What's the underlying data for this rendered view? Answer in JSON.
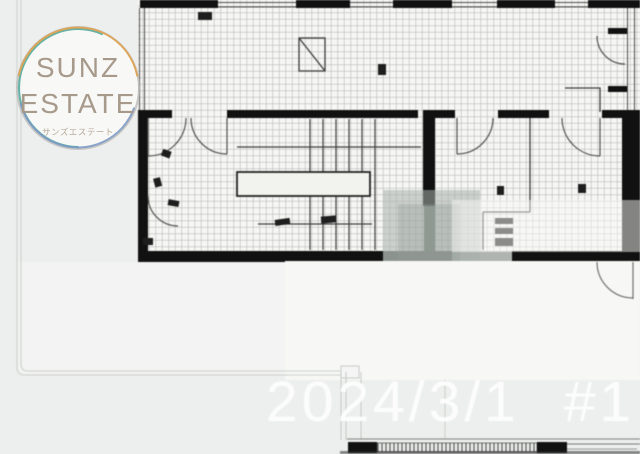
{
  "brand": {
    "line1": "SUNZ",
    "line2": "ESTATE",
    "subtitle_jp": "サンズエステート"
  },
  "watermark": {
    "date_label": "2024/3/1 #1"
  },
  "floor_plan": {
    "description": "blurred black-and-white architectural floor plan on grid paper, partially masked by white and gray patches"
  },
  "theme": {
    "bg": "#edefee",
    "paper": "#f6f6f4",
    "gridLine": "#aeb2ad",
    "wall": "#111111",
    "logoText": "#a79a8b",
    "logoSubText": "#b6a998",
    "ringOrange": "#dfa14b",
    "ringTeal": "#4fa99b",
    "ringBlue": "#7d99c5",
    "ringGray": "#b9bab6",
    "watermark": "#fdfdfd"
  }
}
